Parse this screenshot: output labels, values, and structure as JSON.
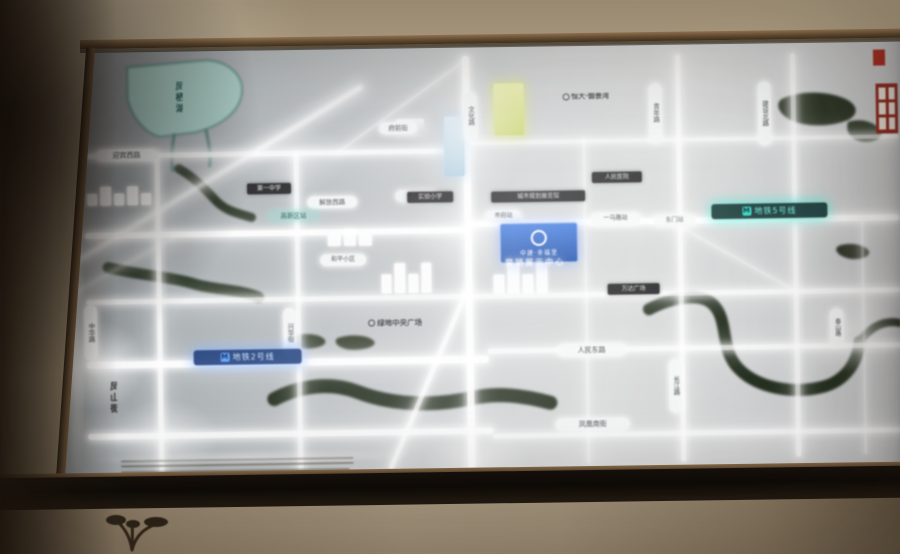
{
  "map": {
    "badge": {
      "title": "中建·幸福里",
      "subtitle": "营销展示中心"
    },
    "accent_colors": {
      "metro5": "#79f0e2",
      "metro2": "#7fb4ff",
      "lake": "#a9cfc8",
      "river": "#1d2818",
      "landmark_yellow": "#d8e08a",
      "badge_blue": "#1547a6",
      "road_glow": "#ffffff"
    },
    "roads": [
      {
        "name": "h1-west",
        "x": 85,
        "y": 148,
        "len": 386,
        "th": 5,
        "dir": "h",
        "op": 0.92
      },
      {
        "name": "h1-east",
        "x": 470,
        "y": 141,
        "len": 430,
        "th": 4,
        "dir": "h",
        "op": 0.75
      },
      {
        "name": "h2-west",
        "x": 85,
        "y": 227,
        "len": 386,
        "th": 6,
        "dir": "h",
        "op": 1
      },
      {
        "name": "h2-east",
        "x": 468,
        "y": 221,
        "len": 432,
        "th": 6,
        "dir": "h",
        "op": 1
      },
      {
        "name": "h3",
        "x": 85,
        "y": 294,
        "len": 815,
        "th": 5,
        "dir": "h",
        "op": 0.85
      },
      {
        "name": "h4-west",
        "x": 85,
        "y": 356,
        "len": 402,
        "th": 7,
        "dir": "h",
        "op": 1
      },
      {
        "name": "h4-east",
        "x": 486,
        "y": 349,
        "len": 414,
        "th": 5,
        "dir": "h",
        "op": 0.85
      },
      {
        "name": "h5-west",
        "x": 85,
        "y": 428,
        "len": 406,
        "th": 6,
        "dir": "h",
        "op": 0.95
      },
      {
        "name": "h5-east",
        "x": 490,
        "y": 434,
        "len": 410,
        "th": 5,
        "dir": "h",
        "op": 0.8
      },
      {
        "name": "v1",
        "x": 156,
        "y": 148,
        "len": 322,
        "th": 5,
        "dir": "v",
        "op": 0.9
      },
      {
        "name": "v2",
        "x": 295,
        "y": 150,
        "len": 320,
        "th": 5,
        "dir": "v",
        "op": 0.85
      },
      {
        "name": "v3-main",
        "x": 465,
        "y": 56,
        "len": 414,
        "th": 7,
        "dir": "v",
        "op": 1
      },
      {
        "name": "v4",
        "x": 584,
        "y": 140,
        "len": 325,
        "th": 3,
        "dir": "v",
        "op": 0.55
      },
      {
        "name": "v5",
        "x": 678,
        "y": 58,
        "len": 407,
        "th": 5,
        "dir": "v",
        "op": 0.85
      },
      {
        "name": "v6",
        "x": 793,
        "y": 58,
        "len": 404,
        "th": 5,
        "dir": "v",
        "op": 0.8
      },
      {
        "name": "v7",
        "x": 861,
        "y": 225,
        "len": 235,
        "th": 3,
        "dir": "v",
        "op": 0.5
      },
      {
        "name": "diag-southwest",
        "x": 470,
        "y": 288,
        "len": 198,
        "th": 5,
        "dir": "d",
        "deg": 114,
        "op": 0.9
      },
      {
        "name": "diag-north",
        "x": 468,
        "y": 62,
        "len": 157,
        "th": 3,
        "dir": "d",
        "deg": 145,
        "op": 0.5
      },
      {
        "name": "diag-east",
        "x": 680,
        "y": 228,
        "len": 134,
        "th": 3,
        "dir": "d",
        "deg": 30,
        "op": 0.45
      }
    ],
    "streaks": [
      {
        "name": "glare-1",
        "x": 78,
        "y": 258,
        "len": 334,
        "th": 5,
        "deg": -31.5,
        "op": 0.85
      },
      {
        "name": "glare-2",
        "x": 62,
        "y": 298,
        "len": 130,
        "th": 3,
        "deg": -29,
        "op": 0.5
      }
    ],
    "water": [
      {
        "name": "lake",
        "kind": "fill",
        "d": "M 130 62 L 210 56 C 232 58 248 72 244 92 C 240 110 222 122 198 128 L 162 132 C 146 128 134 112 130 94 Z",
        "color": "#a9cfc8",
        "stroke": "#5d8d86",
        "sw": 2
      },
      {
        "name": "lake-outlet-1",
        "kind": "stroke",
        "d": "M 176 130 C 174 142 172 152 174 166",
        "color": "#4a7a74",
        "sw": 3
      },
      {
        "name": "lake-outlet-2",
        "kind": "stroke",
        "d": "M 208 126 C 210 138 213 150 211 162",
        "color": "#4a7a74",
        "sw": 3
      },
      {
        "name": "river-northwest",
        "kind": "stroke",
        "d": "M 180 164 C 200 176 210 190 218 198 C 228 208 240 210 252 214",
        "color": "#222e1d",
        "sw": 9
      },
      {
        "name": "river-west",
        "kind": "stroke",
        "d": "M 108 262 C 140 270 170 272 195 280 C 215 286 240 286 258 294",
        "color": "#222e1d",
        "sw": 11
      },
      {
        "name": "river-south",
        "kind": "stroke",
        "d": "M 272 396 C 300 382 330 380 355 390 C 390 404 430 406 470 398 C 495 393 520 396 548 404",
        "color": "#1d2818",
        "sw": 14
      },
      {
        "name": "river-east",
        "kind": "stroke",
        "d": "M 648 312 C 672 300 700 296 712 308 C 728 324 718 352 736 372 C 754 392 790 400 822 392 C 844 386 856 368 858 348",
        "color": "#1d2818",
        "sw": 12
      },
      {
        "name": "river-east-branch",
        "kind": "stroke",
        "d": "M 858 348 C 870 332 884 326 900 330",
        "color": "#1d2818",
        "sw": 8
      },
      {
        "name": "trees-northeast-1",
        "kind": "fill",
        "d": "M 784 104 C 800 96 828 96 846 104 C 860 110 862 120 850 126 C 830 134 800 132 788 122 C 780 116 778 108 784 104 Z",
        "color": "#242e1e"
      },
      {
        "name": "trees-northeast-2",
        "kind": "fill",
        "d": "M 850 128 C 862 124 876 128 882 136 C 886 142 880 148 868 148 C 856 148 846 140 850 128 Z",
        "color": "#242e1e"
      },
      {
        "name": "park-blob-1",
        "kind": "fill",
        "d": "M 290 334 C 300 330 316 331 322 336 C 328 341 320 346 306 346 C 294 346 284 340 290 334 Z",
        "color": "#27311f"
      },
      {
        "name": "park-blob-2",
        "kind": "fill",
        "d": "M 336 336 C 348 332 366 333 372 339 C 377 344 366 348 352 348 C 340 348 330 341 336 336 Z",
        "color": "#27311f"
      },
      {
        "name": "park-blob-3",
        "kind": "fill",
        "d": "M 838 252 C 848 248 862 250 868 256 C 872 261 864 266 852 265 C 842 264 832 257 838 252 Z",
        "color": "#2a2f22"
      }
    ],
    "buildings": [
      {
        "name": "landmark-building-yellow",
        "x": 496,
        "y": 84,
        "w": 30,
        "h": 52,
        "color": "linear-gradient(180deg,#eef2a8,#c9d468)",
        "glow": "rgba(220,230,120,.8)"
      },
      {
        "name": "landmark-building-blue",
        "x": 446,
        "y": 116,
        "w": 20,
        "h": 60,
        "color": "linear-gradient(180deg,#cfe2ee,#9fc2d8)",
        "glow": "rgba(160,200,230,.6)"
      },
      {
        "name": "building-block-white",
        "x": 398,
        "y": 118,
        "w": 28,
        "h": 14,
        "color": "linear-gradient(180deg,#f2f4f4,#cdd4d6)",
        "glow": "rgba(255,255,255,.5)"
      }
    ],
    "clusters": [
      {
        "name": "building-cluster-center",
        "x": 493,
        "y": 262,
        "w": 54,
        "h": 32,
        "bars": 4
      },
      {
        "name": "building-cluster-west-center",
        "x": 381,
        "y": 260,
        "w": 50,
        "h": 32,
        "bars": 4
      },
      {
        "name": "building-cluster-northwest",
        "x": 88,
        "y": 180,
        "w": 64,
        "h": 20,
        "bars": 5
      },
      {
        "name": "building-cluster-lakeside",
        "x": 328,
        "y": 226,
        "w": 44,
        "h": 18,
        "bars": 3
      }
    ],
    "glows": [
      {
        "name": "bloom-top-main-road",
        "x": 408,
        "y": 60,
        "w": 120,
        "h": 150,
        "op": 0.55
      },
      {
        "name": "bloom-center-cross",
        "x": 405,
        "y": 185,
        "w": 130,
        "h": 95,
        "op": 0.5
      },
      {
        "name": "bloom-left-metro",
        "x": 45,
        "y": 312,
        "w": 100,
        "h": 95,
        "op": 0.8
      },
      {
        "name": "bloom-bottom-left",
        "x": 108,
        "y": 392,
        "w": 110,
        "h": 82,
        "op": 0.6
      },
      {
        "name": "bloom-right",
        "x": 792,
        "y": 288,
        "w": 110,
        "h": 92,
        "op": 0.55
      },
      {
        "name": "bloom-bottom-center",
        "x": 418,
        "y": 424,
        "w": 112,
        "h": 72,
        "op": 0.5
      },
      {
        "name": "bloom-lake-east",
        "x": 252,
        "y": 118,
        "w": 100,
        "h": 72,
        "op": 0.4
      },
      {
        "name": "edge-glow-left",
        "x": 60,
        "y": 138,
        "w": 26,
        "h": 336,
        "op": 0.85
      },
      {
        "name": "edge-glow-bottom",
        "x": 80,
        "y": 446,
        "w": 340,
        "h": 16,
        "op": 0.5
      }
    ],
    "dashes": [
      {
        "name": "construction-line-1",
        "x": 118,
        "y": 455,
        "len": 232
      },
      {
        "name": "construction-line-2",
        "x": 118,
        "y": 460,
        "len": 232
      },
      {
        "name": "construction-line-3",
        "x": 118,
        "y": 466,
        "len": 228
      }
    ],
    "labels": [
      {
        "name": "road-label-yingbin-west",
        "text": "迎宾西路",
        "style": "pill-h",
        "x": 97,
        "y": 144,
        "w": 58,
        "fs": 7
      },
      {
        "name": "road-label-fuqian",
        "text": "府前街",
        "style": "pill-h",
        "x": 381,
        "y": 121,
        "w": 34,
        "fs": 6.5
      },
      {
        "name": "road-label-jiefang-west",
        "text": "解放西路",
        "style": "pill-h",
        "x": 308,
        "y": 194,
        "w": 46,
        "fs": 6.5
      },
      {
        "name": "road-label-xinhua",
        "text": "新华街",
        "style": "pill-h",
        "x": 396,
        "y": 189,
        "w": 38,
        "fs": 6,
        "op": 0.85
      },
      {
        "name": "poi-label-heping",
        "text": "和平小区",
        "style": "pill-h",
        "x": 320,
        "y": 252,
        "w": 42,
        "fs": 6
      },
      {
        "name": "station-label-shifu",
        "text": "市府站",
        "style": "pill-h",
        "x": 486,
        "y": 211,
        "w": 32,
        "fs": 6
      },
      {
        "name": "station-label-yimalu",
        "text": "一马路站",
        "style": "pill-h",
        "x": 591,
        "y": 215,
        "w": 46,
        "fs": 6
      },
      {
        "name": "station-label-dongmen",
        "text": "东门站",
        "style": "pill-h",
        "x": 654,
        "y": 218,
        "w": 38,
        "fs": 6,
        "op": 0.8
      },
      {
        "name": "road-label-renmin-east",
        "text": "人民东路",
        "style": "pill-h",
        "x": 556,
        "y": 346,
        "w": 64,
        "fs": 7
      },
      {
        "name": "road-label-fenghuang-south",
        "text": "凤凰南街",
        "style": "pill-h",
        "x": 553,
        "y": 420,
        "w": 70,
        "fs": 7
      },
      {
        "name": "poi-label-yujingwan",
        "text": "恒大·御景湾",
        "style": "poi-dark",
        "x": 546,
        "y": 95,
        "w": 84,
        "fs": 7
      },
      {
        "name": "poi-label-lvdi-plaza",
        "text": "绿地中央广场",
        "style": "poi-dark",
        "x": 348,
        "y": 318,
        "w": 92,
        "fs": 7.5
      },
      {
        "name": "road-label-wenhua",
        "text": "文化路",
        "style": "pill-v",
        "x": 466,
        "y": 92,
        "h": 42,
        "fs": 6.5
      },
      {
        "name": "road-label-qingnian",
        "text": "青年路",
        "style": "pill-v",
        "x": 651,
        "y": 86,
        "h": 54,
        "fs": 6.5
      },
      {
        "name": "road-label-jianshe-north",
        "text": "建设北路",
        "style": "pill-v",
        "x": 760,
        "y": 86,
        "h": 58,
        "fs": 6.5
      },
      {
        "name": "road-label-zhonghua",
        "text": "中华路",
        "style": "pill-v",
        "x": 83,
        "y": 299,
        "h": 50,
        "fs": 6.5
      },
      {
        "name": "road-label-xinghua",
        "text": "兴华街",
        "style": "pill-v",
        "x": 282,
        "y": 305,
        "h": 44,
        "fs": 6.5
      },
      {
        "name": "road-label-changjiang",
        "text": "长江路",
        "style": "pill-v",
        "x": 667,
        "y": 362,
        "h": 48,
        "fs": 6.5
      },
      {
        "name": "road-label-taishan",
        "text": "泰山路",
        "style": "pill-v",
        "x": 829,
        "y": 314,
        "h": 32,
        "fs": 6
      },
      {
        "name": "road-label-fengshan",
        "text": "凤山街",
        "style": "text-v",
        "x": 106,
        "y": 368,
        "h": 48,
        "fs": 9,
        "color": "#24231f"
      },
      {
        "name": "lake-label",
        "text": "凤栖湖",
        "style": "text-v",
        "x": 176,
        "y": 70,
        "h": 46,
        "fs": 9,
        "color": "#184f4b"
      },
      {
        "name": "poi-label-no1-school",
        "text": "第一中学",
        "style": "pill-dark",
        "x": 248,
        "y": 180,
        "w": 38,
        "fs": 6
      },
      {
        "name": "poi-label-exp-school",
        "text": "实验小学",
        "style": "pill-dark",
        "x": 408,
        "y": 191,
        "w": 40,
        "fs": 6
      },
      {
        "name": "poi-label-planning-hall",
        "text": "城市规划展览馆",
        "style": "pill-dark",
        "x": 492,
        "y": 192,
        "w": 88,
        "fs": 6
      },
      {
        "name": "poi-label-hospital",
        "text": "人民医院",
        "style": "pill-dark",
        "x": 593,
        "y": 174,
        "w": 44,
        "fs": 6
      },
      {
        "name": "poi-label-wanda",
        "text": "万达广场",
        "style": "pill-dark",
        "x": 607,
        "y": 286,
        "w": 46,
        "fs": 6
      },
      {
        "name": "metro-line5-label",
        "text": "地铁5号线",
        "style": "metro-teal",
        "x": 712,
        "y": 208,
        "w": 108,
        "fs": 8
      },
      {
        "name": "metro-line2-label",
        "text": "地铁2号线",
        "style": "metro-blue",
        "x": 192,
        "y": 346,
        "w": 100,
        "fs": 8
      },
      {
        "name": "station-label-gaoxin",
        "text": "高新区站",
        "style": "metro-teal-dim",
        "x": 268,
        "y": 207,
        "w": 46,
        "fs": 6.5
      }
    ]
  }
}
